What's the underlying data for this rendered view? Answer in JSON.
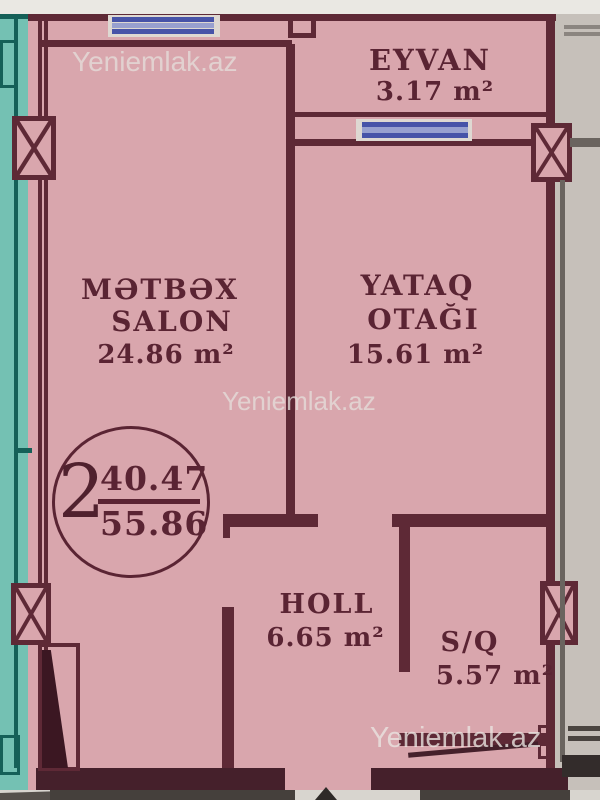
{
  "plan": {
    "watermark": "Yeniemlak.az",
    "rooms": {
      "eyvan": {
        "name": "EYVAN",
        "area": "3.17 m²"
      },
      "metbex": {
        "line1": "MƏTBƏX",
        "line2": "SALON",
        "area": "24.86 m²"
      },
      "yataq": {
        "line1": "YATAQ",
        "line2": "OTAĞI",
        "area": "15.61 m²"
      },
      "holl": {
        "name": "HOLL",
        "area": "6.65 m²"
      },
      "sq": {
        "name": "S/Q",
        "area": "5.57 m²"
      }
    },
    "badge": {
      "rooms_count": "2",
      "area_top": "40.47",
      "area_bottom": "55.86"
    },
    "colors": {
      "room_fill_pink": "#d9a6ad",
      "wall_maroon": "#5e2936",
      "balcony_teal": "#74c1b3",
      "teal_dark": "#156058",
      "window_blue": "#4753a8",
      "outside_grey": "#c6c0ba",
      "text_maroon": "#5a2433"
    }
  }
}
